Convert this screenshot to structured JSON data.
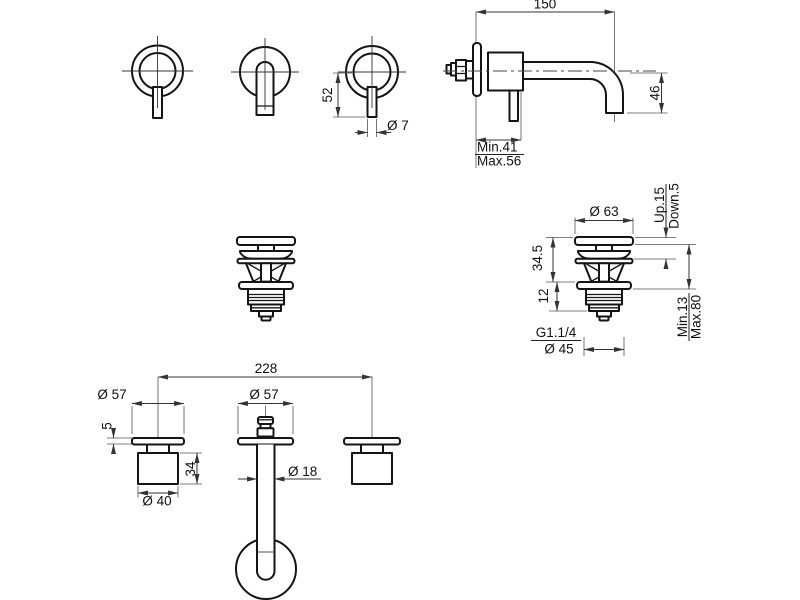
{
  "document": {
    "type": "technical-drawing",
    "product": "wall-mounted basin mixer with lever handles and pop-up waste",
    "background": "#ffffff",
    "line_color": "#141414",
    "views": {
      "handles": {
        "label": "handle front and side views",
        "dims": {
          "lever_length": "52",
          "lever_diameter": "Ø 7"
        }
      },
      "mixer_side": {
        "label": "wall-mounted mixer side view",
        "dims": {
          "spout_reach": "150",
          "outlet_height": "46",
          "wall_depth_min": "Min.41",
          "wall_depth_max": "Max.56"
        }
      },
      "drain": {
        "label": "pop-up waste views",
        "dims": {
          "cap_diameter": "Ø 63",
          "travel_up": "Up.15",
          "travel_down": "Down.5",
          "upper_height": "34.5",
          "flange_height": "12",
          "thread": "G1.1/4",
          "body_diameter": "Ø 45",
          "depth_min": "Min.13",
          "depth_max": "Max.80"
        }
      },
      "installation": {
        "label": "built-in body front view",
        "dims": {
          "centers_distance": "228",
          "valve_flange_diameter": "Ø 57",
          "spout_flange_diameter": "Ø 57",
          "flange_thickness": "5",
          "valve_body_height": "34",
          "valve_body_diameter": "Ø 40",
          "spout_tube_diameter": "Ø 18"
        }
      }
    }
  }
}
